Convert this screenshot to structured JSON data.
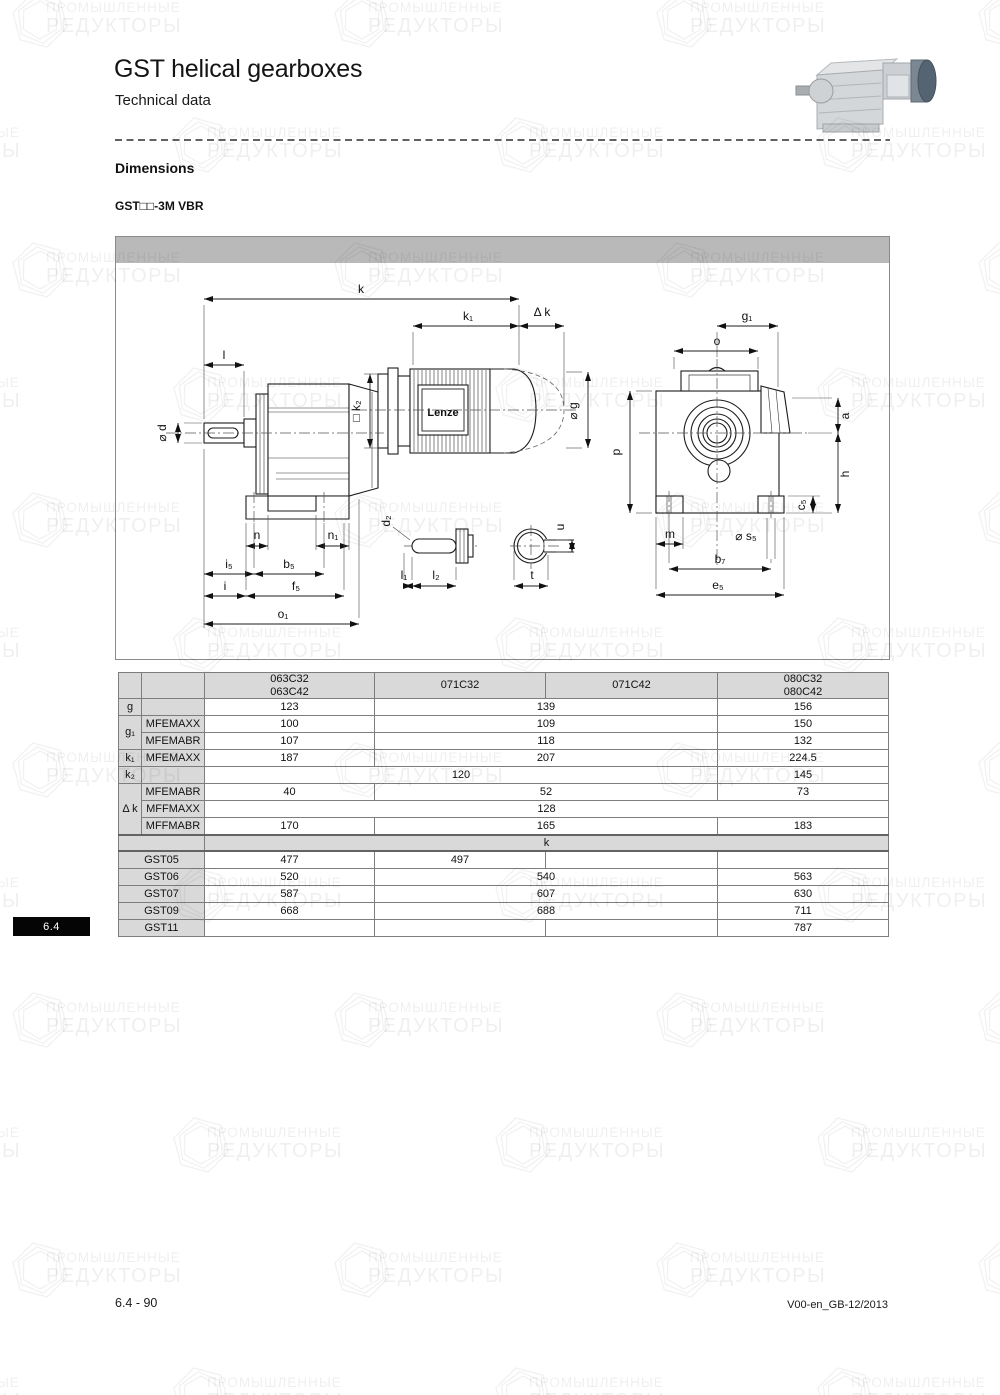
{
  "page": {
    "title": "GST helical gearboxes",
    "subtitle": "Technical data",
    "section_heading": "Dimensions",
    "variant_label": "GST□□-3M VBR",
    "tab_label": "6.4",
    "footer_left": "6.4 - 90",
    "footer_right": "V00-en_GB-12/2013"
  },
  "watermark": {
    "line1": "ПРОМЫШЛЕННЫЕ",
    "line2": "РЕДУКТОРЫ"
  },
  "drawing": {
    "brand": "Lenze",
    "labels": {
      "k": "k",
      "k1": "k₁",
      "dk": "Δ k",
      "l": "l",
      "d": "⌀ d",
      "k2": "□ k₂",
      "g": "⌀ g",
      "n": "n",
      "n1": "n₁",
      "i5": "i₅",
      "b5": "b₅",
      "i": "i",
      "f5": "f₅",
      "o1": "o₁",
      "d2": "d₂",
      "l1": "l₁",
      "l2": "l₂",
      "t": "t",
      "u": "u",
      "g1": "g₁",
      "o": "o",
      "p": "p",
      "a": "a",
      "h": "h",
      "c5": "c₅",
      "m": "m",
      "s5": "⌀ s₅",
      "b7": "b₇",
      "e5": "e₅"
    }
  },
  "table": {
    "headers": {
      "c1a": "063C32",
      "c1b": "063C42",
      "c2": "071C32",
      "c3": "071C42",
      "c4a": "080C32",
      "c4b": "080C42"
    },
    "g": {
      "label": "g",
      "v1": "123",
      "v23": "139",
      "v4": "156"
    },
    "g1": {
      "label": "g₁"
    },
    "g1_maxx": {
      "sub": "MFEMAXX",
      "v1": "100",
      "v23": "109",
      "v4": "150"
    },
    "g1_mabr": {
      "sub": "MFEMABR",
      "v1": "107",
      "v23": "118",
      "v4": "132"
    },
    "k1": {
      "label": "k₁",
      "sub": "MFEMAXX",
      "v1": "187",
      "v23": "207",
      "v4": "224.5"
    },
    "k2": {
      "label": "k₂",
      "v123": "120",
      "v4": "145"
    },
    "dk": {
      "label": "Δ k"
    },
    "dk_femabr": {
      "sub": "MFEMABR",
      "v1": "40",
      "v23": "52",
      "v4": "73"
    },
    "dk_ffmaxx": {
      "sub": "MFFMAXX",
      "v1234": "128"
    },
    "dk_ffmabr": {
      "sub": "MFFMABR",
      "v1": "170",
      "v23": "165",
      "v4": "183"
    },
    "k_band": "k",
    "gst": [
      {
        "label": "GST05",
        "v1": "477",
        "v2": "497",
        "v3": "",
        "v4": ""
      },
      {
        "label": "GST06",
        "v1": "520",
        "v23": "540",
        "v4": "563"
      },
      {
        "label": "GST07",
        "v1": "587",
        "v23": "607",
        "v4": "630"
      },
      {
        "label": "GST09",
        "v1": "668",
        "v23": "688",
        "v4": "711"
      },
      {
        "label": "GST11",
        "v1": "",
        "v2": "",
        "v3": "",
        "v4": "787"
      }
    ]
  }
}
